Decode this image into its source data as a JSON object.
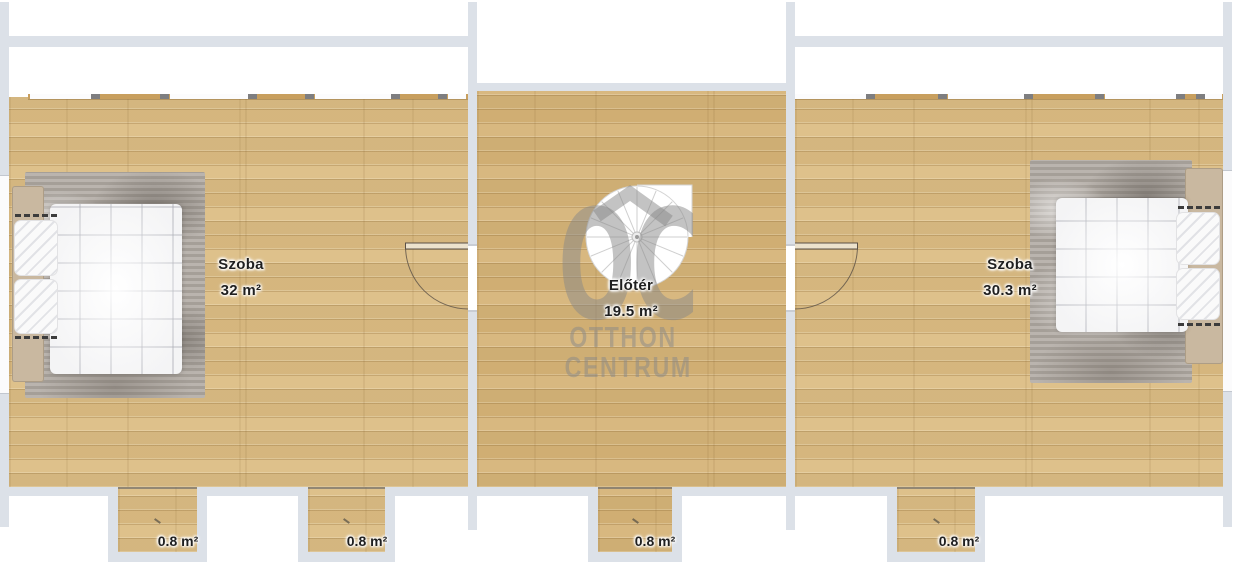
{
  "rooms": [
    {
      "name": "Szoba",
      "area": "32 m²"
    },
    {
      "name": "Előtér",
      "area": "19.5 m²"
    },
    {
      "name": "Szoba",
      "area": "30.3 m²"
    }
  ],
  "alcoves": [
    {
      "area": "0.8 m²"
    },
    {
      "area": "0.8 m²"
    },
    {
      "area": "0.8 m²"
    },
    {
      "area": "0.8 m²"
    }
  ],
  "watermark": {
    "logo": "OC",
    "line1": "OTTHON",
    "line2": "CENTRUM"
  },
  "colors": {
    "wall": "#dce1e8",
    "floor": "#dcbd84",
    "floor_center": "#d6b478",
    "label": "#1f1f1f",
    "watermark": "#888888"
  }
}
